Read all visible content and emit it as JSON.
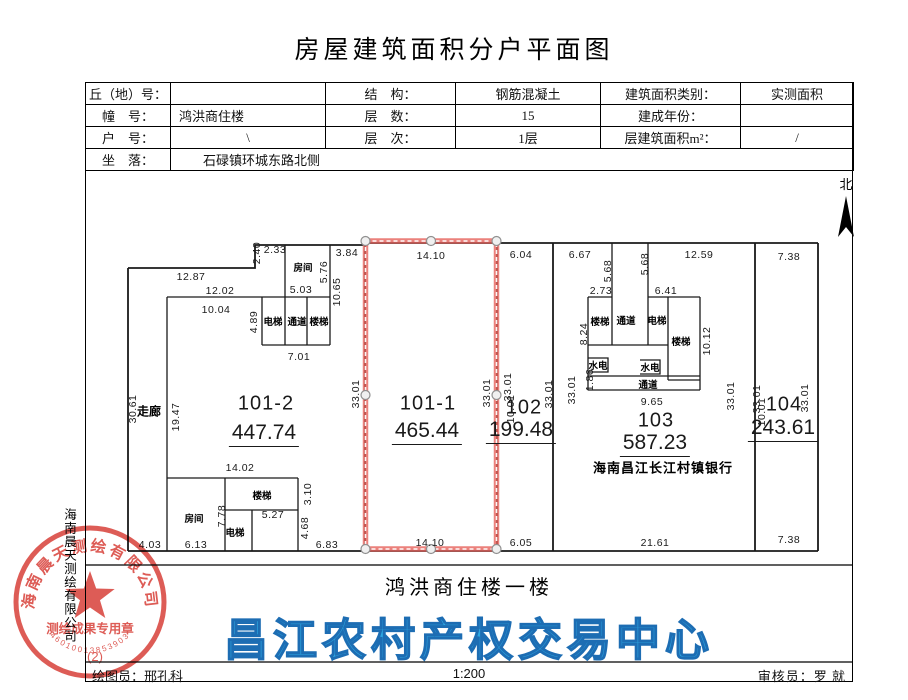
{
  "title": "房屋建筑面积分户平面图",
  "info_table": {
    "rows": [
      {
        "c1": "丘（地）号：",
        "v1": "",
        "c2": "结　构：",
        "v2": "钢筋混凝土",
        "c3": "建筑面积类别：",
        "v3": "实测面积"
      },
      {
        "c1": "幢　号：",
        "v1": "鸿洪商住楼",
        "c2": "层　数：",
        "v2": "15",
        "c3": "建成年份：",
        "v3": ""
      },
      {
        "c1": "户　号：",
        "v1": "\\",
        "c2": "层　次：",
        "v2": "1层",
        "c3": "层建筑面积m²：",
        "v3": "/"
      }
    ],
    "site_label": "坐　落：",
    "site_value": "石碌镇环城东路北侧"
  },
  "north_label": "北",
  "plan": {
    "units": [
      {
        "id": "101-2",
        "area": "447.74",
        "x": 266,
        "y": 404,
        "ax": 264,
        "ay": 434
      },
      {
        "id": "101-1",
        "area": "465.44",
        "x": 428,
        "y": 404,
        "ax": 427,
        "ay": 432
      },
      {
        "id": "102",
        "area": "199.48",
        "x": 524,
        "y": 408,
        "ax": 521,
        "ay": 431
      },
      {
        "id": "103",
        "area": "587.23",
        "x": 656,
        "y": 421,
        "ax": 655,
        "ay": 444,
        "note": "海南昌江长江村镇银行",
        "nx": 663,
        "ny": 467
      },
      {
        "id": "104",
        "area": "243.61",
        "x": 784,
        "y": 405,
        "ax": 783,
        "ay": 429
      }
    ],
    "rooms": [
      {
        "t": "房间",
        "x": 303,
        "y": 267
      },
      {
        "t": "电梯",
        "x": 273,
        "y": 321
      },
      {
        "t": "通道",
        "x": 297,
        "y": 321
      },
      {
        "t": "楼梯",
        "x": 319,
        "y": 321
      },
      {
        "t": "楼梯",
        "x": 262,
        "y": 495
      },
      {
        "t": "房间",
        "x": 194,
        "y": 518
      },
      {
        "t": "电梯",
        "x": 235,
        "y": 532
      },
      {
        "t": "楼梯",
        "x": 600,
        "y": 321
      },
      {
        "t": "通道",
        "x": 626,
        "y": 320
      },
      {
        "t": "电梯",
        "x": 657,
        "y": 320
      },
      {
        "t": "楼梯",
        "x": 681,
        "y": 341
      },
      {
        "t": "水电",
        "x": 598,
        "y": 365
      },
      {
        "t": "水电",
        "x": 650,
        "y": 367
      },
      {
        "t": "通道",
        "x": 648,
        "y": 384
      }
    ],
    "corridor": {
      "t": "走廊",
      "x": 149,
      "y": 411
    },
    "dims": [
      {
        "t": "12.87",
        "x": 191,
        "y": 277,
        "r": 0
      },
      {
        "t": "12.02",
        "x": 220,
        "y": 291,
        "r": 0
      },
      {
        "t": "10.04",
        "x": 216,
        "y": 310,
        "r": 0
      },
      {
        "t": "2.40",
        "x": 257,
        "y": 253,
        "r": -90
      },
      {
        "t": "2.33",
        "x": 275,
        "y": 250,
        "r": 0
      },
      {
        "t": "3.84",
        "x": 347,
        "y": 253,
        "r": 0
      },
      {
        "t": "5.03",
        "x": 301,
        "y": 290,
        "r": 0
      },
      {
        "t": "5.76",
        "x": 324,
        "y": 272,
        "r": -90
      },
      {
        "t": "10.65",
        "x": 337,
        "y": 292,
        "r": -90
      },
      {
        "t": "4.89",
        "x": 254,
        "y": 322,
        "r": -90
      },
      {
        "t": "7.01",
        "x": 299,
        "y": 357,
        "r": 0
      },
      {
        "t": "30.61",
        "x": 133,
        "y": 409,
        "r": -90
      },
      {
        "t": "19.47",
        "x": 176,
        "y": 417,
        "r": -90
      },
      {
        "t": "14.02",
        "x": 240,
        "y": 468,
        "r": 0
      },
      {
        "t": "3.10",
        "x": 308,
        "y": 494,
        "r": -90
      },
      {
        "t": "7.78",
        "x": 222,
        "y": 516,
        "r": -90
      },
      {
        "t": "5.27",
        "x": 273,
        "y": 515,
        "r": 0
      },
      {
        "t": "4.68",
        "x": 305,
        "y": 528,
        "r": -90
      },
      {
        "t": "4.03",
        "x": 150,
        "y": 545,
        "r": 0
      },
      {
        "t": "6.13",
        "x": 196,
        "y": 545,
        "r": 0
      },
      {
        "t": "6.83",
        "x": 327,
        "y": 545,
        "r": 0
      },
      {
        "t": "14.10",
        "x": 431,
        "y": 256,
        "r": 0
      },
      {
        "t": "14.10",
        "x": 430,
        "y": 543,
        "r": 0
      },
      {
        "t": "33.01",
        "x": 356,
        "y": 394,
        "r": -90
      },
      {
        "t": "33.01",
        "x": 487,
        "y": 393,
        "r": -90
      },
      {
        "t": "6.04",
        "x": 521,
        "y": 255,
        "r": 0
      },
      {
        "t": "33.01",
        "x": 508,
        "y": 387,
        "r": -90
      },
      {
        "t": "10.01",
        "x": 511,
        "y": 409,
        "r": -90
      },
      {
        "t": "33.01",
        "x": 549,
        "y": 394,
        "r": -90
      },
      {
        "t": "33.01",
        "x": 572,
        "y": 390,
        "r": -90
      },
      {
        "t": "6.05",
        "x": 521,
        "y": 543,
        "r": 0
      },
      {
        "t": "6.67",
        "x": 580,
        "y": 255,
        "r": 0
      },
      {
        "t": "12.59",
        "x": 699,
        "y": 255,
        "r": 0
      },
      {
        "t": "5.68",
        "x": 608,
        "y": 271,
        "r": -90
      },
      {
        "t": "5.68",
        "x": 645,
        "y": 264,
        "r": -90
      },
      {
        "t": "2.73",
        "x": 601,
        "y": 291,
        "r": 0
      },
      {
        "t": "6.41",
        "x": 666,
        "y": 291,
        "r": 0
      },
      {
        "t": "8.24",
        "x": 584,
        "y": 334,
        "r": -90
      },
      {
        "t": "10.12",
        "x": 707,
        "y": 341,
        "r": -90
      },
      {
        "t": "1.86",
        "x": 590,
        "y": 380,
        "r": -90
      },
      {
        "t": "9.65",
        "x": 652,
        "y": 402,
        "r": 0
      },
      {
        "t": "21.61",
        "x": 655,
        "y": 543,
        "r": 0
      },
      {
        "t": "33.01",
        "x": 731,
        "y": 396,
        "r": -90
      },
      {
        "t": "33.01",
        "x": 757,
        "y": 399,
        "r": -90
      },
      {
        "t": "10.01",
        "x": 762,
        "y": 412,
        "r": -90
      },
      {
        "t": "33.01",
        "x": 805,
        "y": 398,
        "r": -90
      },
      {
        "t": "7.38",
        "x": 789,
        "y": 257,
        "r": 0
      },
      {
        "t": "7.38",
        "x": 789,
        "y": 540,
        "r": 0
      }
    ]
  },
  "caption": "鸿洪商住楼一楼",
  "watermark": "昌江农村产权交易中心",
  "stamp": {
    "company": "海南晨天测绘有限公司",
    "type_text": "测绘成果专用章",
    "code": "46010013853903",
    "suffix": "(2)"
  },
  "side_text": "海南晨天测绘有限公司",
  "footer": {
    "left": "绘图员：邢孔科",
    "scale": "1:200",
    "right": "审核员：罗 就"
  }
}
